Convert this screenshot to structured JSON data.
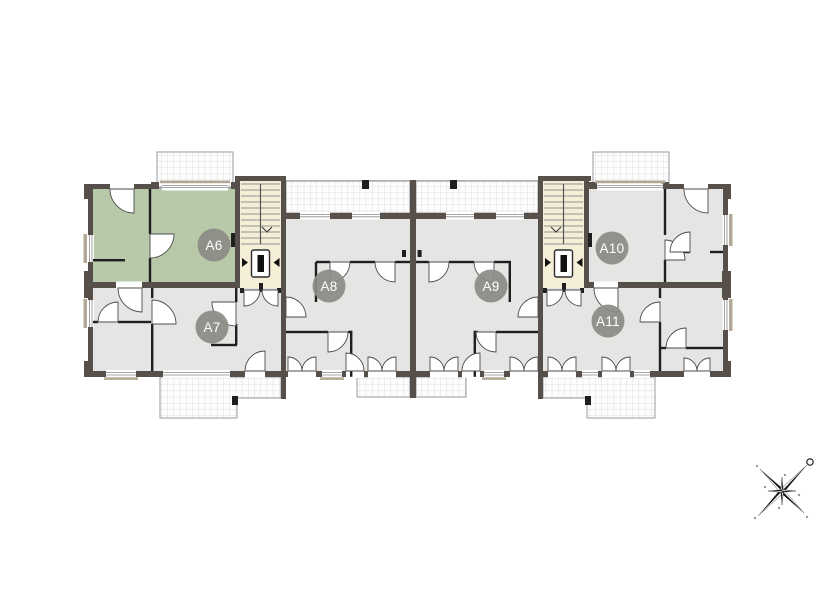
{
  "floor_plan": {
    "units": [
      {
        "id": "a6",
        "label": "A6",
        "highlighted": true
      },
      {
        "id": "a7",
        "label": "A7",
        "highlighted": false
      },
      {
        "id": "a8",
        "label": "A8",
        "highlighted": false
      },
      {
        "id": "a9",
        "label": "A9",
        "highlighted": false
      },
      {
        "id": "a10",
        "label": "A10",
        "highlighted": false
      },
      {
        "id": "a11",
        "label": "A11",
        "highlighted": false
      }
    ],
    "colors": {
      "unit_highlight": "#b8c9a9",
      "unit_default": "#e5e5e4",
      "stairwell": "#f5efd7",
      "wall": "#57504a",
      "partition": "#1f1f1f",
      "terrace_border": "#9b9b9b",
      "terrace_grid": "#d6d6d6",
      "label_bg": "#8c8c85",
      "label_text": "#ffffff"
    },
    "compass": {
      "north": "upper-right"
    }
  }
}
